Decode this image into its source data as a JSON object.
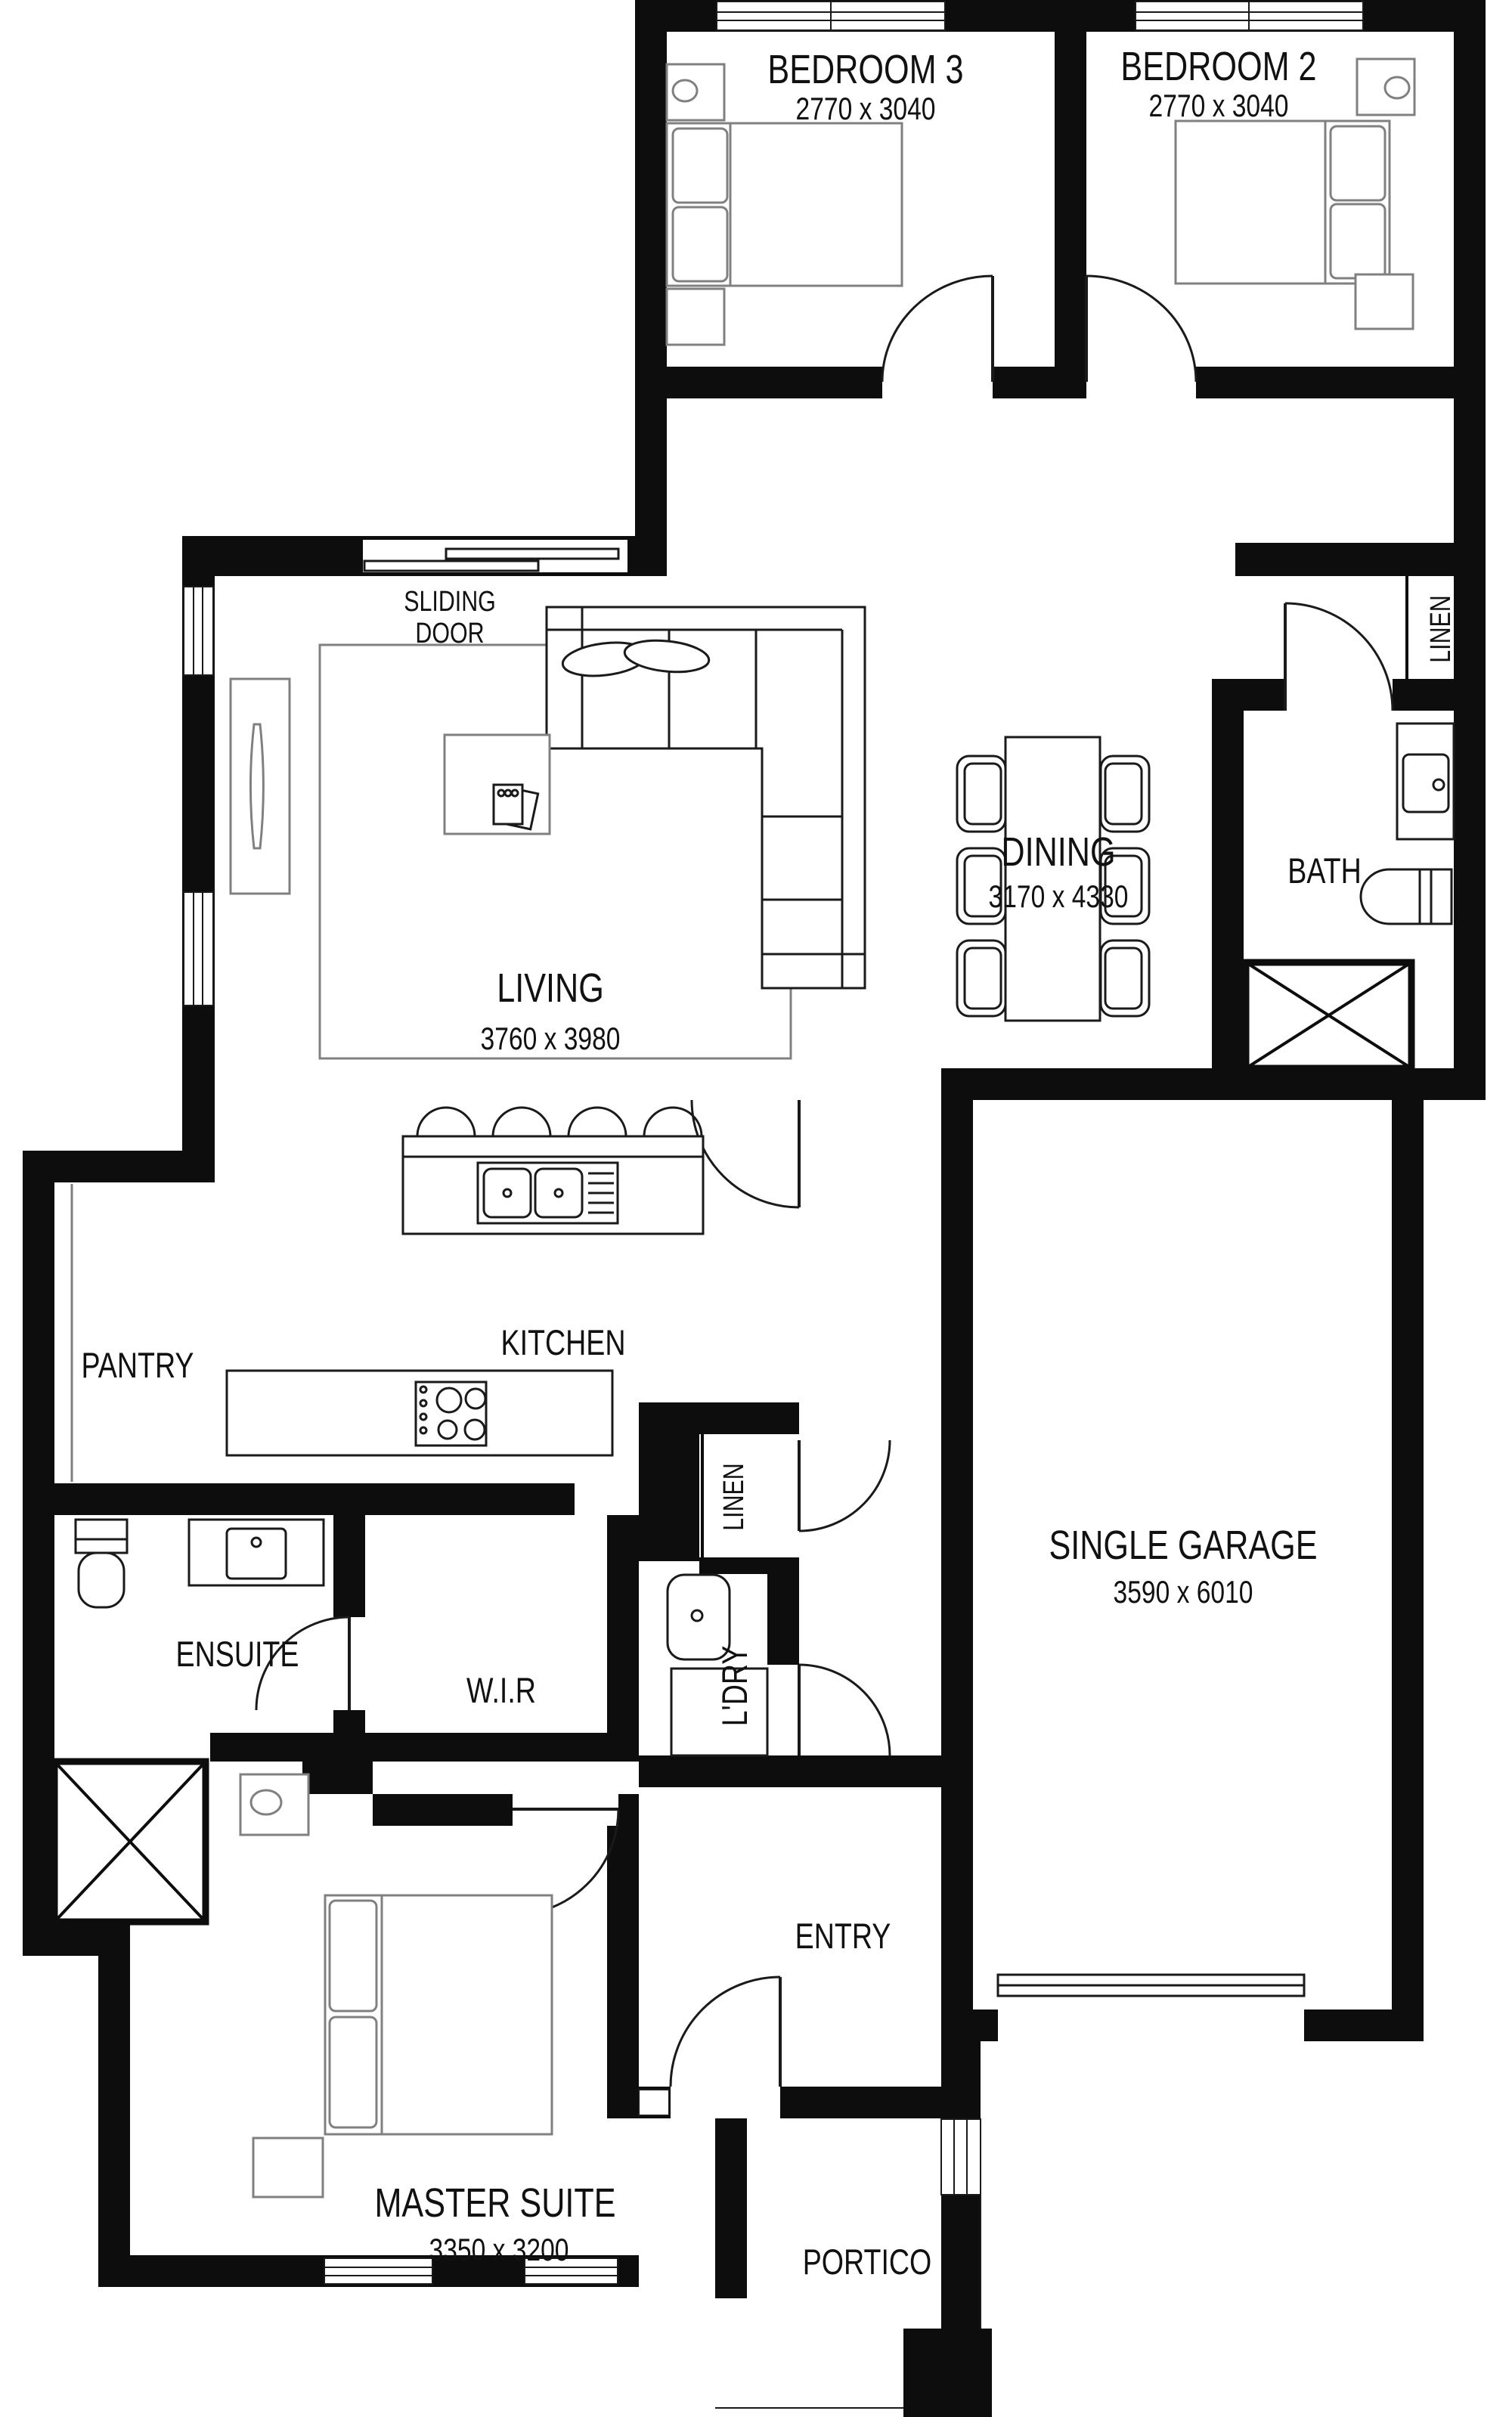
{
  "plan": {
    "title": "Single storey house floor plan",
    "rooms": {
      "bedroom3": {
        "name": "BEDROOM 3",
        "dims": "2770 x 3040"
      },
      "bedroom2": {
        "name": "BEDROOM 2",
        "dims": "2770 x 3040"
      },
      "living": {
        "name": "LIVING",
        "dims": "3760 x 3980"
      },
      "dining": {
        "name": "DINING",
        "dims": "3170 x 4330"
      },
      "bath": {
        "name": "BATH"
      },
      "kitchen": {
        "name": "KITCHEN"
      },
      "pantry": {
        "name": "PANTRY"
      },
      "garage": {
        "name": "SINGLE GARAGE",
        "dims": "3590 x 6010"
      },
      "ensuite": {
        "name": "ENSUITE"
      },
      "wir": {
        "name": "W.I.R"
      },
      "laundry": {
        "name": "L'DRY"
      },
      "entry": {
        "name": "ENTRY"
      },
      "master": {
        "name": "MASTER SUITE",
        "dims": "3350 x 3200"
      },
      "portico": {
        "name": "PORTICO"
      }
    },
    "closets": {
      "linen_bath": "LINEN",
      "linen_hall": "LINEN"
    },
    "annotations": {
      "sliding_door_line1": "SLIDING",
      "sliding_door_line2": "DOOR"
    },
    "colors": {
      "wall": "#0d0d0d",
      "fixture_outline": "#1a1a1a",
      "furniture_outline": "#808080",
      "background": "#ffffff",
      "text": "#111111"
    }
  }
}
